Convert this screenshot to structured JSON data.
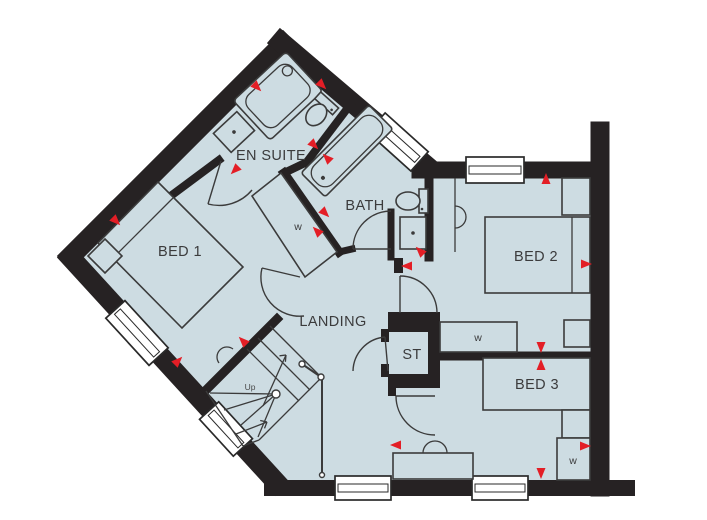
{
  "colors": {
    "floor": "#cddce2",
    "wall": "#262223",
    "line": "#3b3b3b",
    "accent_red": "#e31e26",
    "window_fill": "#ffffff",
    "background": "#ffffff"
  },
  "rooms": {
    "en_suite": "EN SUITE",
    "bath": "BATH",
    "bed1": "BED 1",
    "bed2": "BED 2",
    "bed3": "BED 3",
    "landing": "LANDING",
    "store": "ST"
  },
  "stairs": {
    "up": "Up"
  },
  "wardrobe": {
    "label": "w"
  }
}
